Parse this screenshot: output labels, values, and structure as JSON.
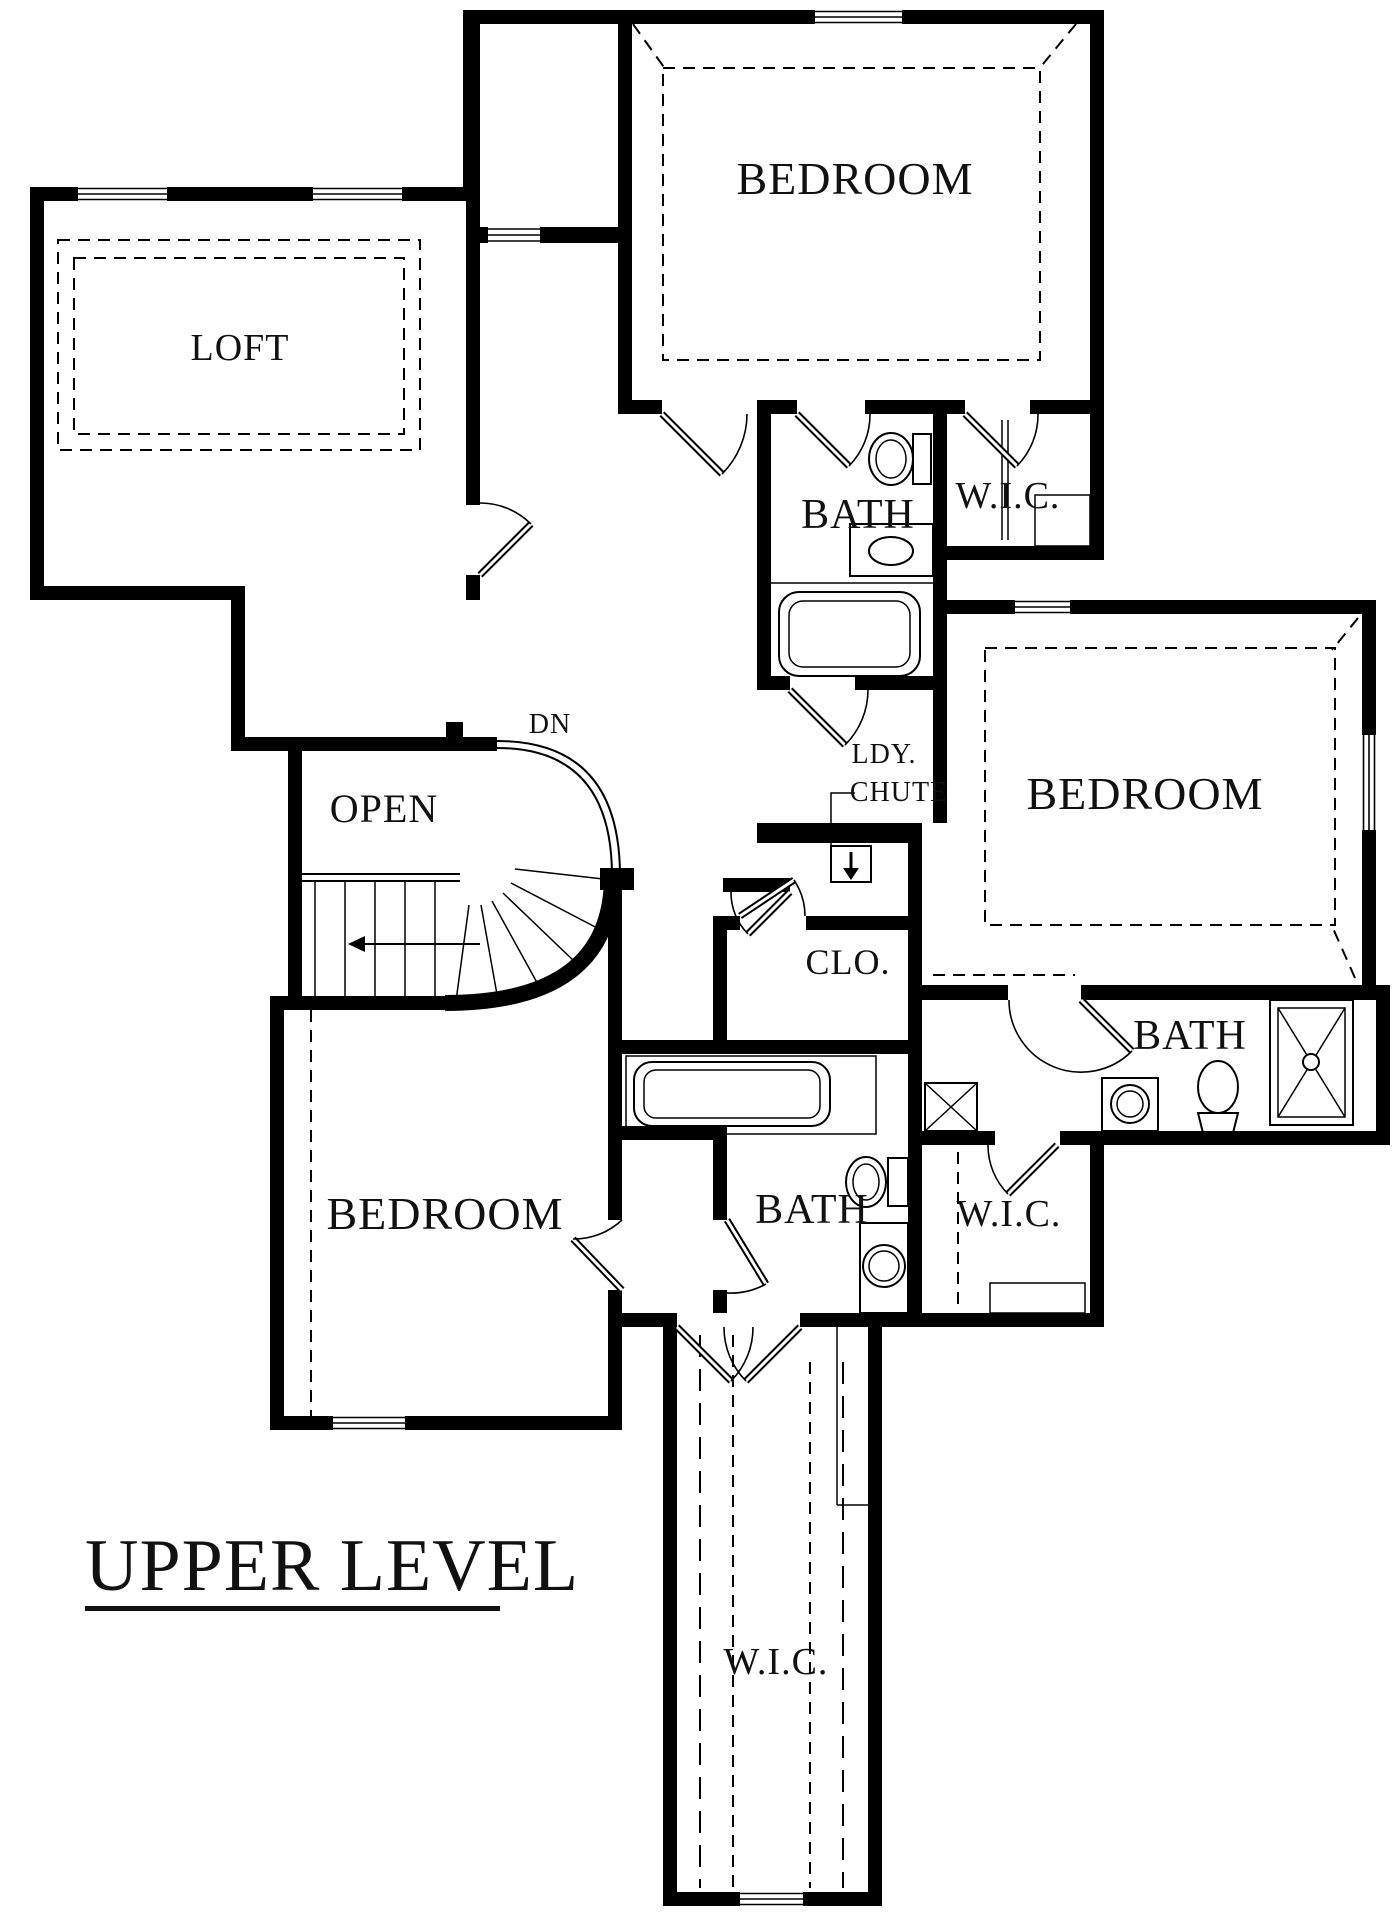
{
  "title": {
    "text": "UPPER LEVEL"
  },
  "rooms": {
    "loft": {
      "label": "LOFT"
    },
    "bedroom_top": {
      "label": "BEDROOM"
    },
    "bath_top": {
      "label": "BATH"
    },
    "wic_top": {
      "label": "W.I.C."
    },
    "bedroom_right": {
      "label": "BEDROOM"
    },
    "bath_right": {
      "label": "BATH"
    },
    "closet": {
      "label": "CLO."
    },
    "open_stairwell": {
      "label": "OPEN"
    },
    "bedroom_lower": {
      "label": "BEDROOM"
    },
    "bath_lower": {
      "label": "BATH"
    },
    "wic_lower": {
      "label": "W.I.C."
    },
    "wic_bottom": {
      "label": "W.I.C."
    }
  },
  "annotations": {
    "stairs_down": "DN",
    "laundry_chute_line1": "LDY.",
    "laundry_chute_line2": "CHUTE"
  },
  "colors": {
    "wall": "#000000",
    "background": "#ffffff",
    "label": "#111111"
  }
}
